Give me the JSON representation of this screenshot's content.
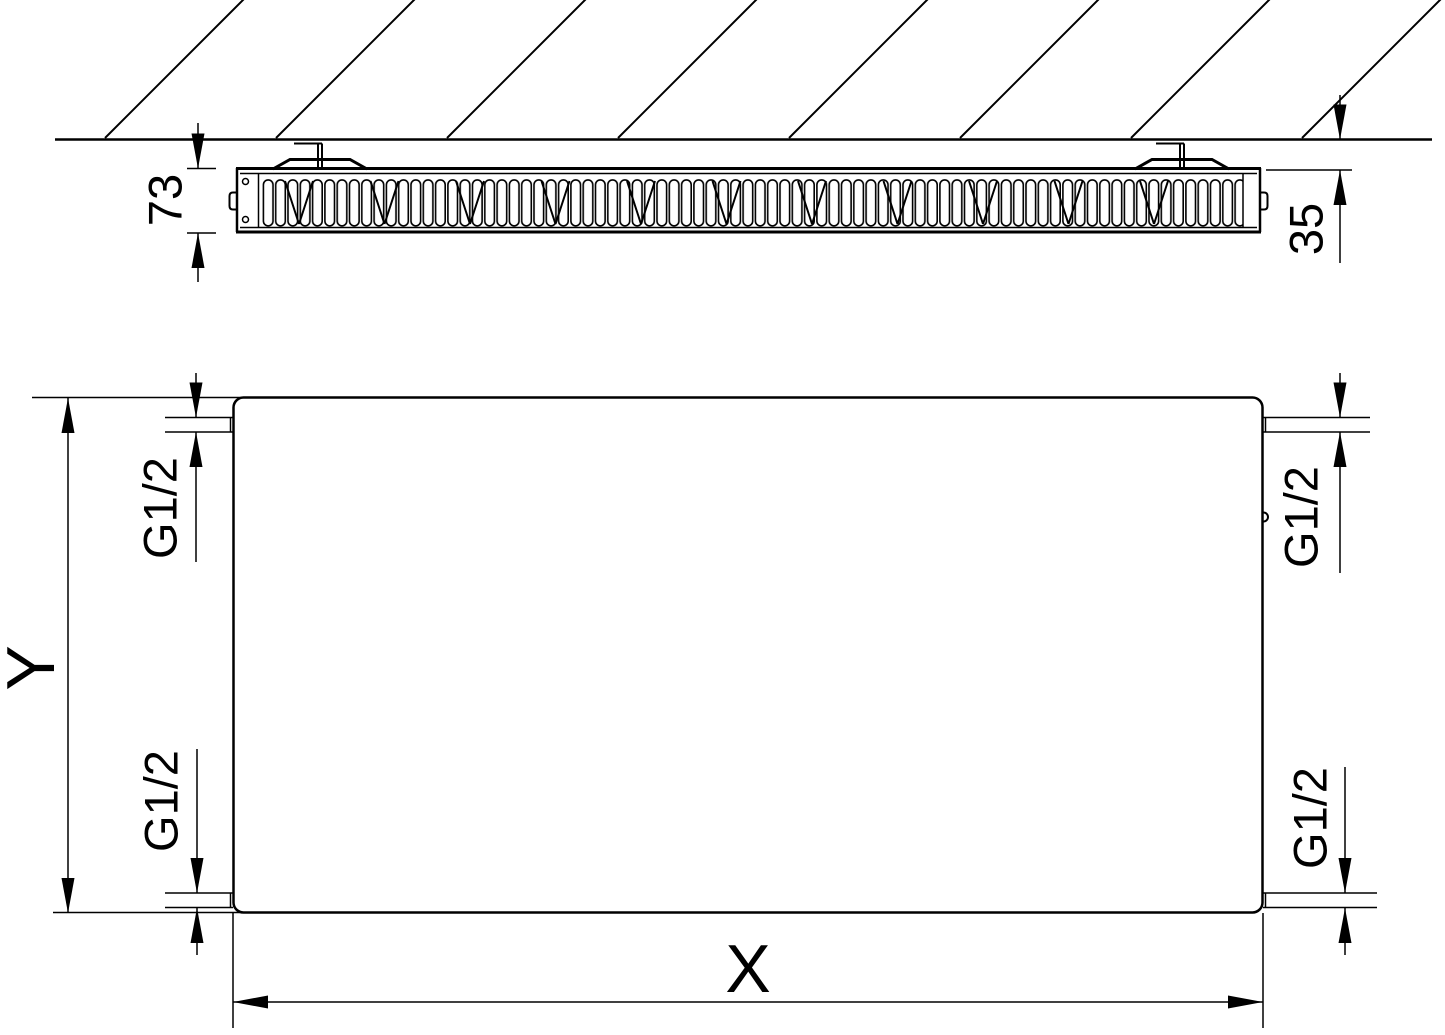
{
  "page": {
    "background": "#ffffff",
    "line_color": "#000000",
    "description": "Technical drawing of a flat panel radiator: top cross-section view with wall mounting and front view with connection threads"
  },
  "top_view": {
    "depth_label": "73",
    "wall_distance_label": "35"
  },
  "front_view": {
    "width_label": "X",
    "height_label": "Y",
    "thread_top_left": "G1/2",
    "thread_top_right": "G1/2",
    "thread_bottom_left": "G1/2",
    "thread_bottom_right": "G1/2"
  }
}
